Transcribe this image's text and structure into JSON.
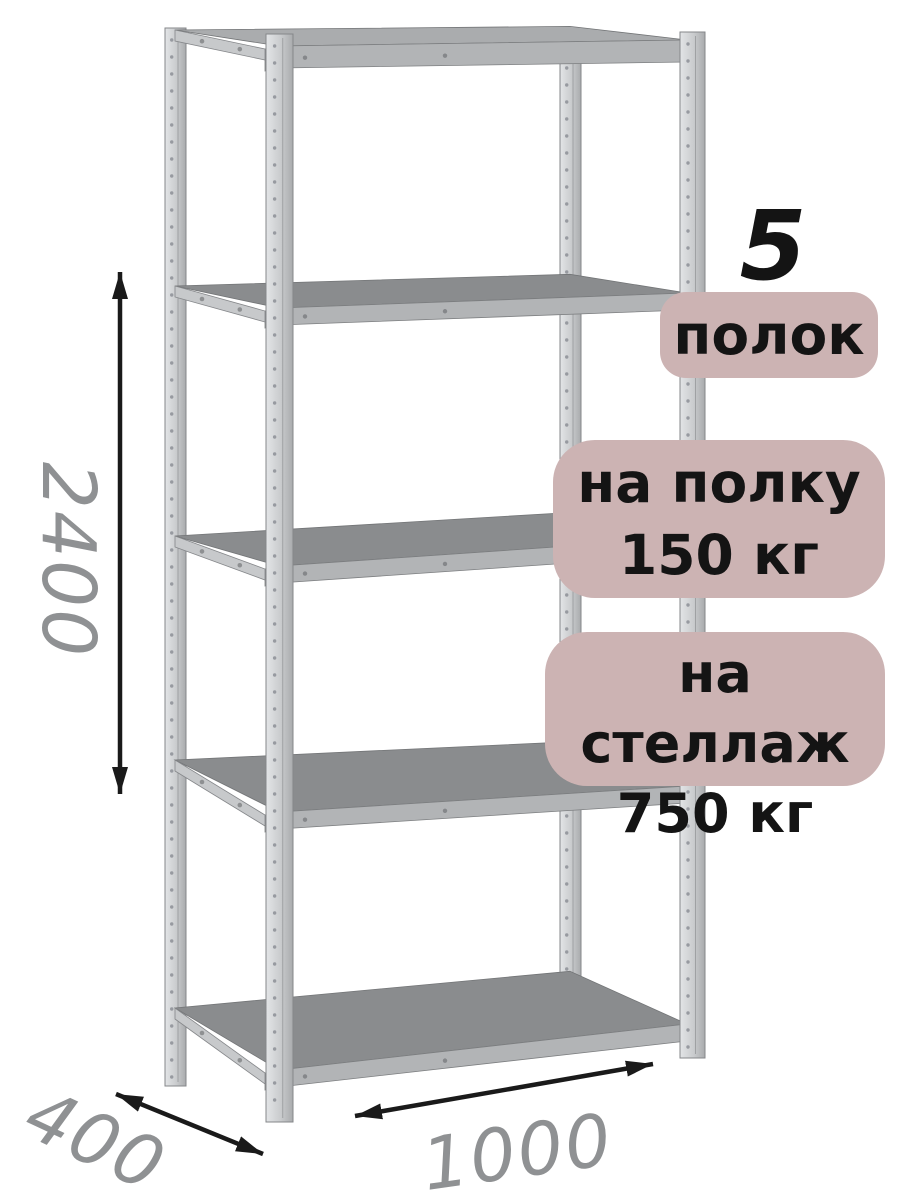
{
  "badges": {
    "count": {
      "number": "5",
      "label": "полок"
    },
    "shelf_load": {
      "line1": "на полку",
      "line2": "150 кг"
    },
    "rack_load": {
      "line1": "на стеллаж",
      "line2": "750 кг"
    }
  },
  "dimensions": {
    "height": "2400",
    "depth": "400",
    "width": "1000"
  },
  "colors": {
    "background": "#ffffff",
    "badge_bg": "#ccb3b3",
    "badge_text": "#141414",
    "dimension_text": "#8f9193",
    "arrow": "#1a1a1a",
    "metal_light": "#e3e5e7",
    "metal_mid": "#b2b4b6",
    "metal_dark": "#8a8c8e",
    "metal_beam": "#c7c9cb",
    "metal_edge": "#85878a"
  }
}
